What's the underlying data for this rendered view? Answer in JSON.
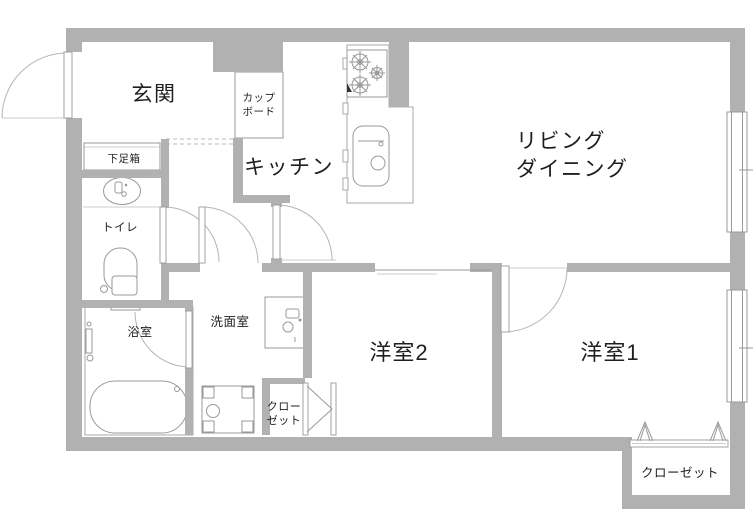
{
  "meta": {
    "type": "floor-plan",
    "colors": {
      "wall": "#b1b1b1",
      "fixture_line": "#999999",
      "door_arc": "#b5b5b5",
      "text": "#1f1f1f",
      "background": "#ffffff"
    }
  },
  "rooms": {
    "genkan": {
      "label": "玄関"
    },
    "cupboard": {
      "line1": "カップ",
      "line2": "ボード"
    },
    "kitchen": {
      "label": "キッチン"
    },
    "living": {
      "line1": "リビング",
      "line2": "ダイニング"
    },
    "shoebox": {
      "label": "下足箱"
    },
    "toilet": {
      "label": "トイレ"
    },
    "bathroom": {
      "label": "浴室"
    },
    "washroom": {
      "label": "洗面室"
    },
    "closet_washroom": {
      "line1": "クロー",
      "line2": "ゼット"
    },
    "youshitsu2": {
      "label": "洋室2"
    },
    "youshitsu1": {
      "label": "洋室1"
    },
    "closet_youshitsu1": {
      "label": "クローゼット"
    }
  },
  "fixtures": [
    "entrance-door",
    "shoe-cabinet",
    "wash-basin",
    "toilet-bowl",
    "bathtub",
    "shower-mixer",
    "bathroom-door",
    "toilet-door",
    "washroom-door",
    "kitchen-door",
    "cupboard",
    "gas-stove",
    "kitchen-sink",
    "kitchen-counter",
    "vanity-sink",
    "washing-machine-pan",
    "bifold-closet-door",
    "folding-closet-door",
    "living-window",
    "bedroom-window",
    "room1-door"
  ]
}
